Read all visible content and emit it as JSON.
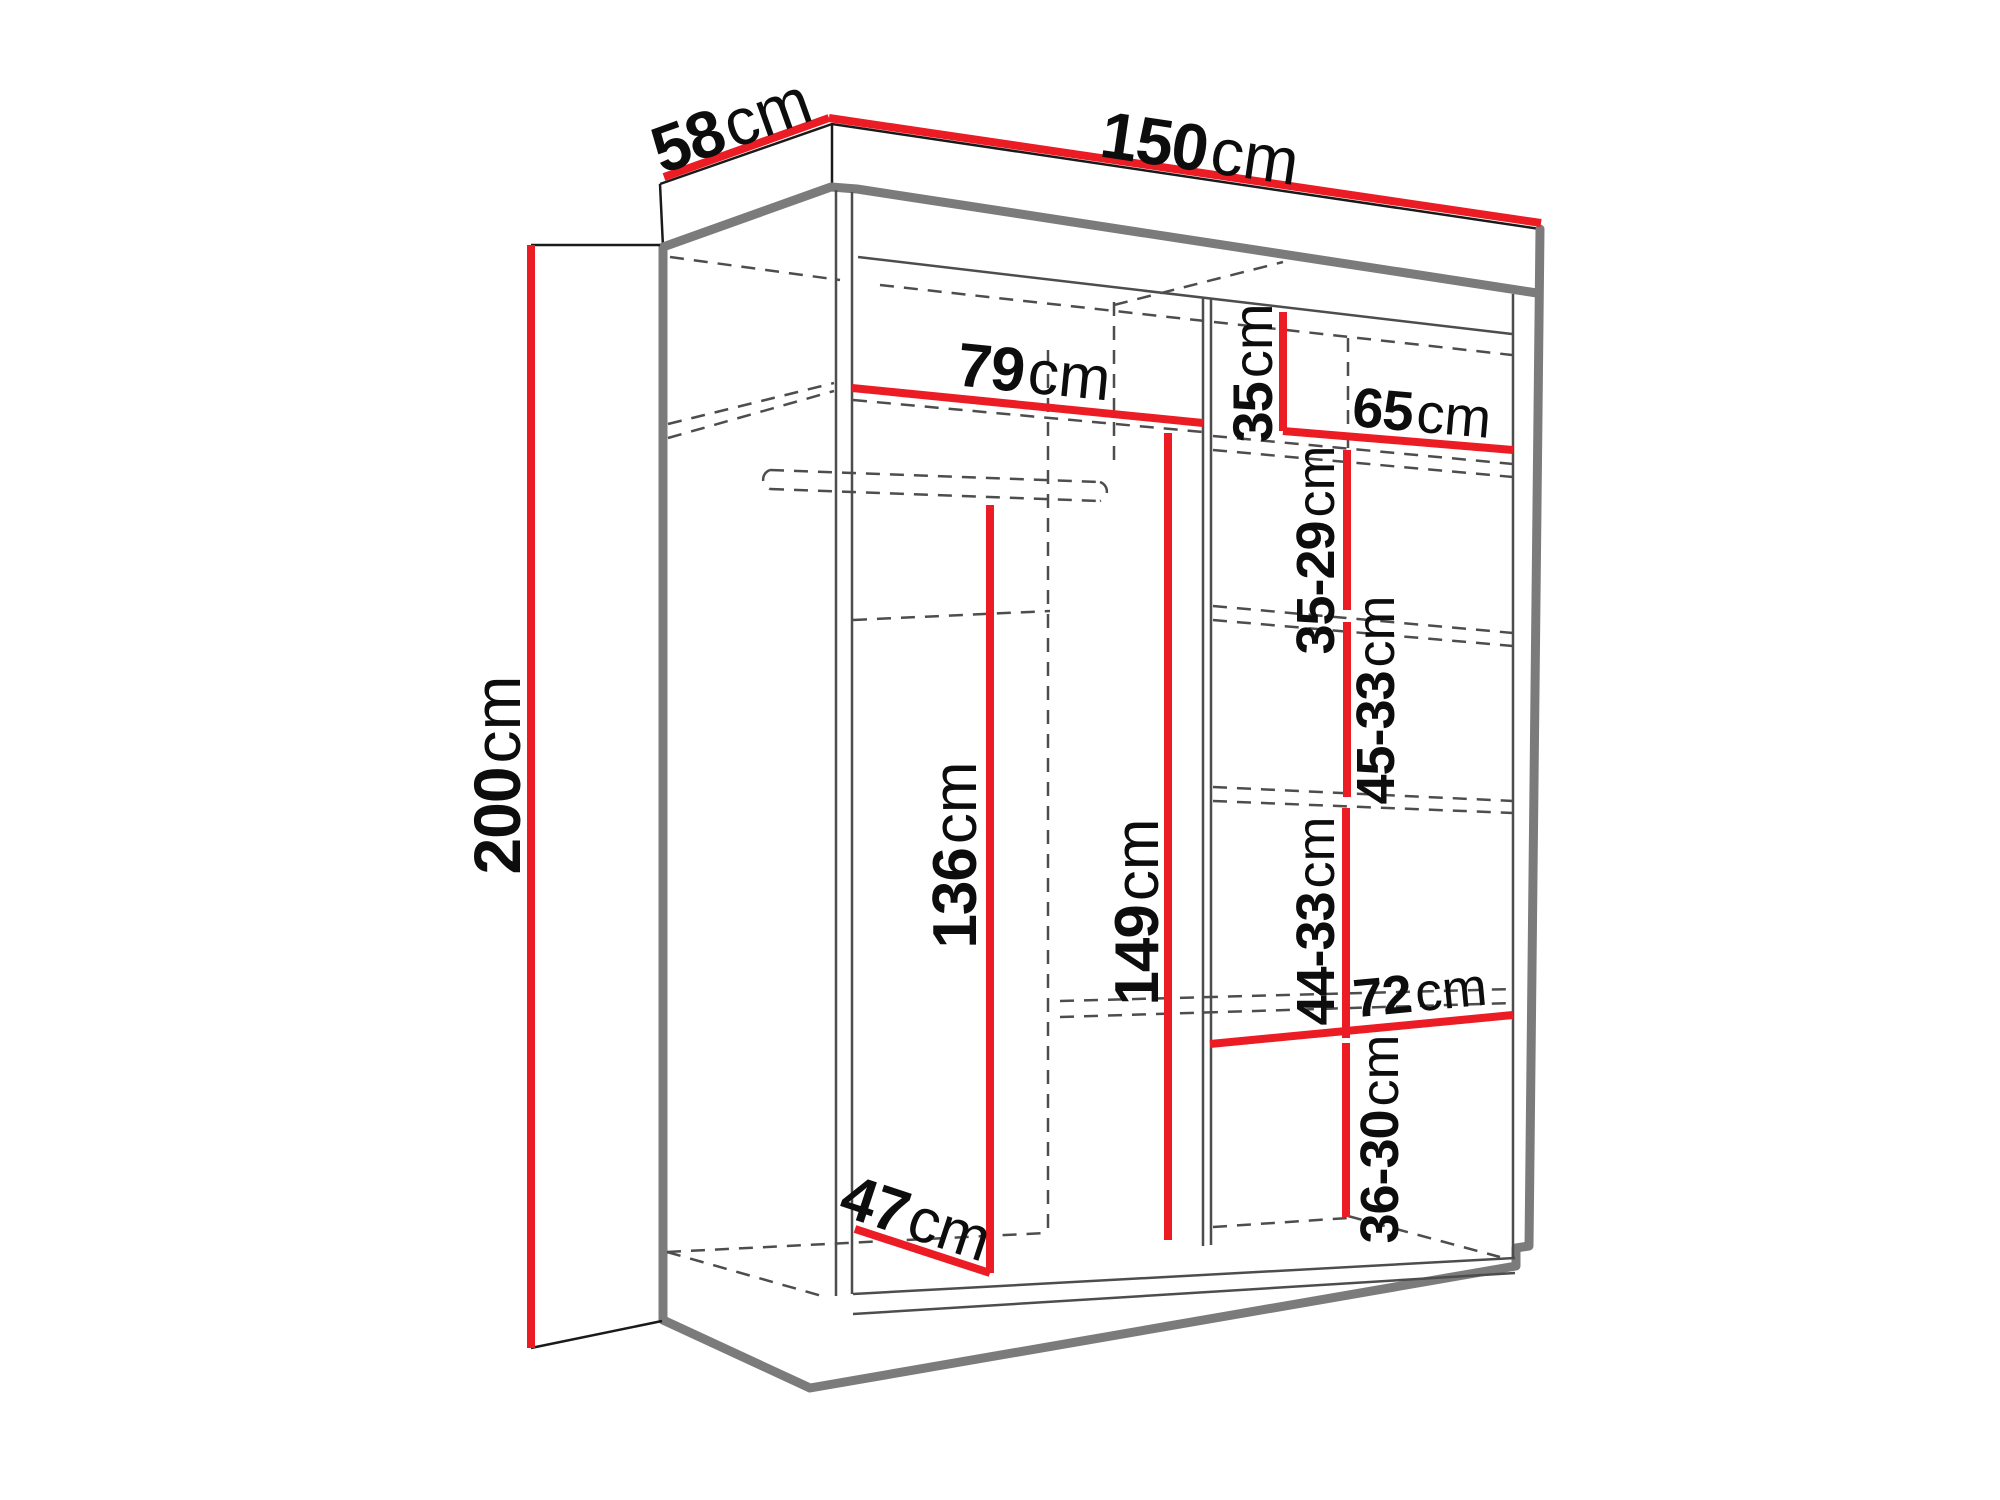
{
  "diagram": {
    "type": "furniture-dimension-diagram",
    "subject": "wardrobe interior dimensions",
    "colors": {
      "dimension_line": "#ec1c24",
      "outline": "#7b7b7b",
      "text": "#0d0d0d",
      "background": "#ffffff"
    },
    "dims": {
      "width": {
        "value": "150",
        "unit": "cm"
      },
      "depth": {
        "value": "58",
        "unit": "cm"
      },
      "height": {
        "value": "200",
        "unit": "cm"
      },
      "left_width": {
        "value": "79",
        "unit": "cm"
      },
      "top_shelf": {
        "value": "35",
        "unit": "cm"
      },
      "right_width": {
        "value": "65",
        "unit": "cm"
      },
      "gap1": {
        "value": "35-29",
        "unit": "cm"
      },
      "gap2": {
        "value": "45-33",
        "unit": "cm"
      },
      "hang_height": {
        "value": "136",
        "unit": "cm"
      },
      "right_height": {
        "value": "149",
        "unit": "cm"
      },
      "gap3": {
        "value": "44-33",
        "unit": "cm"
      },
      "bottom_width": {
        "value": "72",
        "unit": "cm"
      },
      "gap4": {
        "value": "36-30",
        "unit": "cm"
      },
      "floor_depth": {
        "value": "47",
        "unit": "cm"
      }
    }
  }
}
